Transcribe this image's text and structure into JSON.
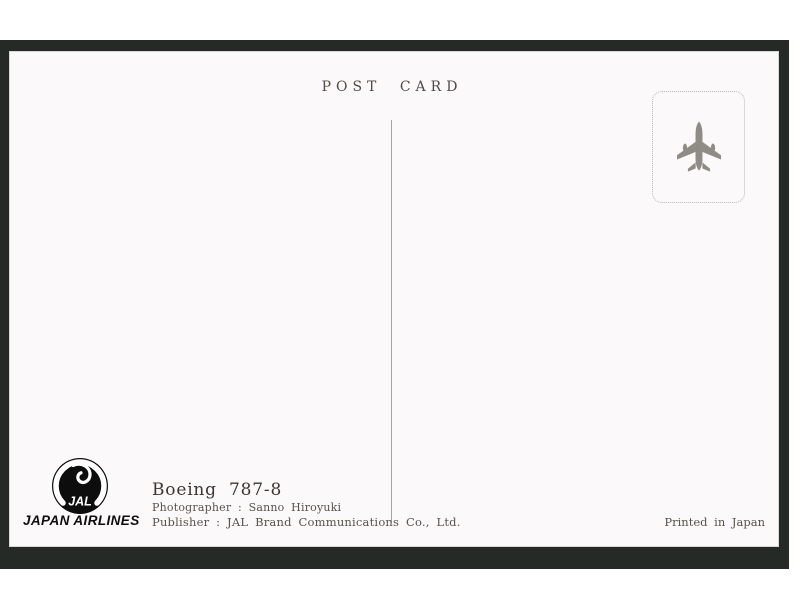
{
  "postcard": {
    "title": "POST CARD",
    "stamp": {
      "icon": "airplane-top-view-icon"
    },
    "brand": {
      "logo_text": "JAL",
      "airline_name": "JAPAN AIRLINES"
    },
    "credits": {
      "aircraft": "Boeing 787-8",
      "photographer": "Photographer : Sanno Hiroyuki",
      "publisher": "Publisher : JAL Brand Communications Co., Ltd."
    },
    "printed_note": "Printed in Japan",
    "colors": {
      "frame_background": "#262a26",
      "card_background": "#fbf9f9",
      "title_text": "#514c47",
      "credit_text": "#57524c",
      "plane_icon": "#8e8c84",
      "divider_line": "#a3a3a1",
      "logo": "#0d0d0d"
    }
  }
}
